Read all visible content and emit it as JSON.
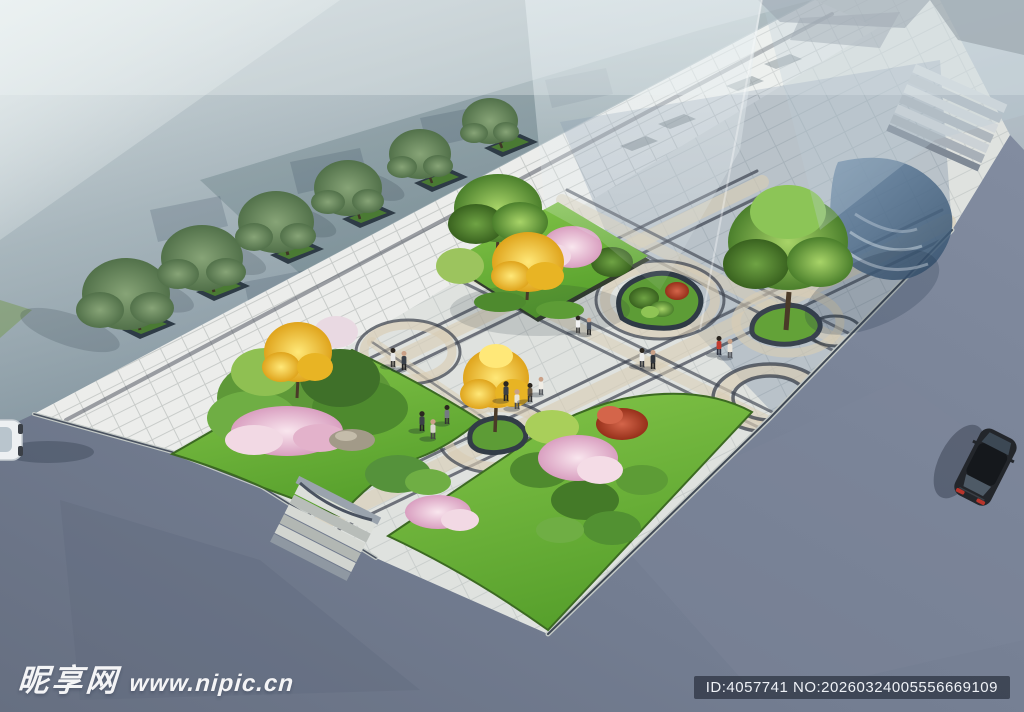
{
  "watermark": {
    "site_name": "昵享网",
    "site_url": "www.nipic.cn",
    "id_text": "ID:4057741 NO:20260324005556669109"
  },
  "scene": {
    "type": "aerial 3D architectural rendering of a landscaped pocket plaza",
    "building": "hazy glass facade occupying upper-left, entrance canopy with wide steps at upper-right",
    "plaza": "light paving with circular ring inlays, beige striped walkways, teardrop planting islands",
    "street_trees": 6,
    "ginkgo_trees": 3,
    "cherry_blossom_masses": 4,
    "red_shrubs": 2,
    "pedestrians": 15,
    "vehicles": [
      "black sedan on right road",
      "white car partially visible at left edge"
    ]
  },
  "palette": {
    "mist": "#cfd8da",
    "road": "#747e92",
    "paving": "#e3e5e1",
    "paving_shadow": "#8fa3b8",
    "accent_band": "#d8cdb6",
    "inlay_dark": "#4d5560",
    "lawn": "#6fb63c",
    "foliage_green": "#5d9738",
    "foliage_yellow": "#f2c43a",
    "foliage_pink": "#eec9da",
    "foliage_red": "#bf4a2e",
    "glass_canopy": "#4a6583"
  }
}
